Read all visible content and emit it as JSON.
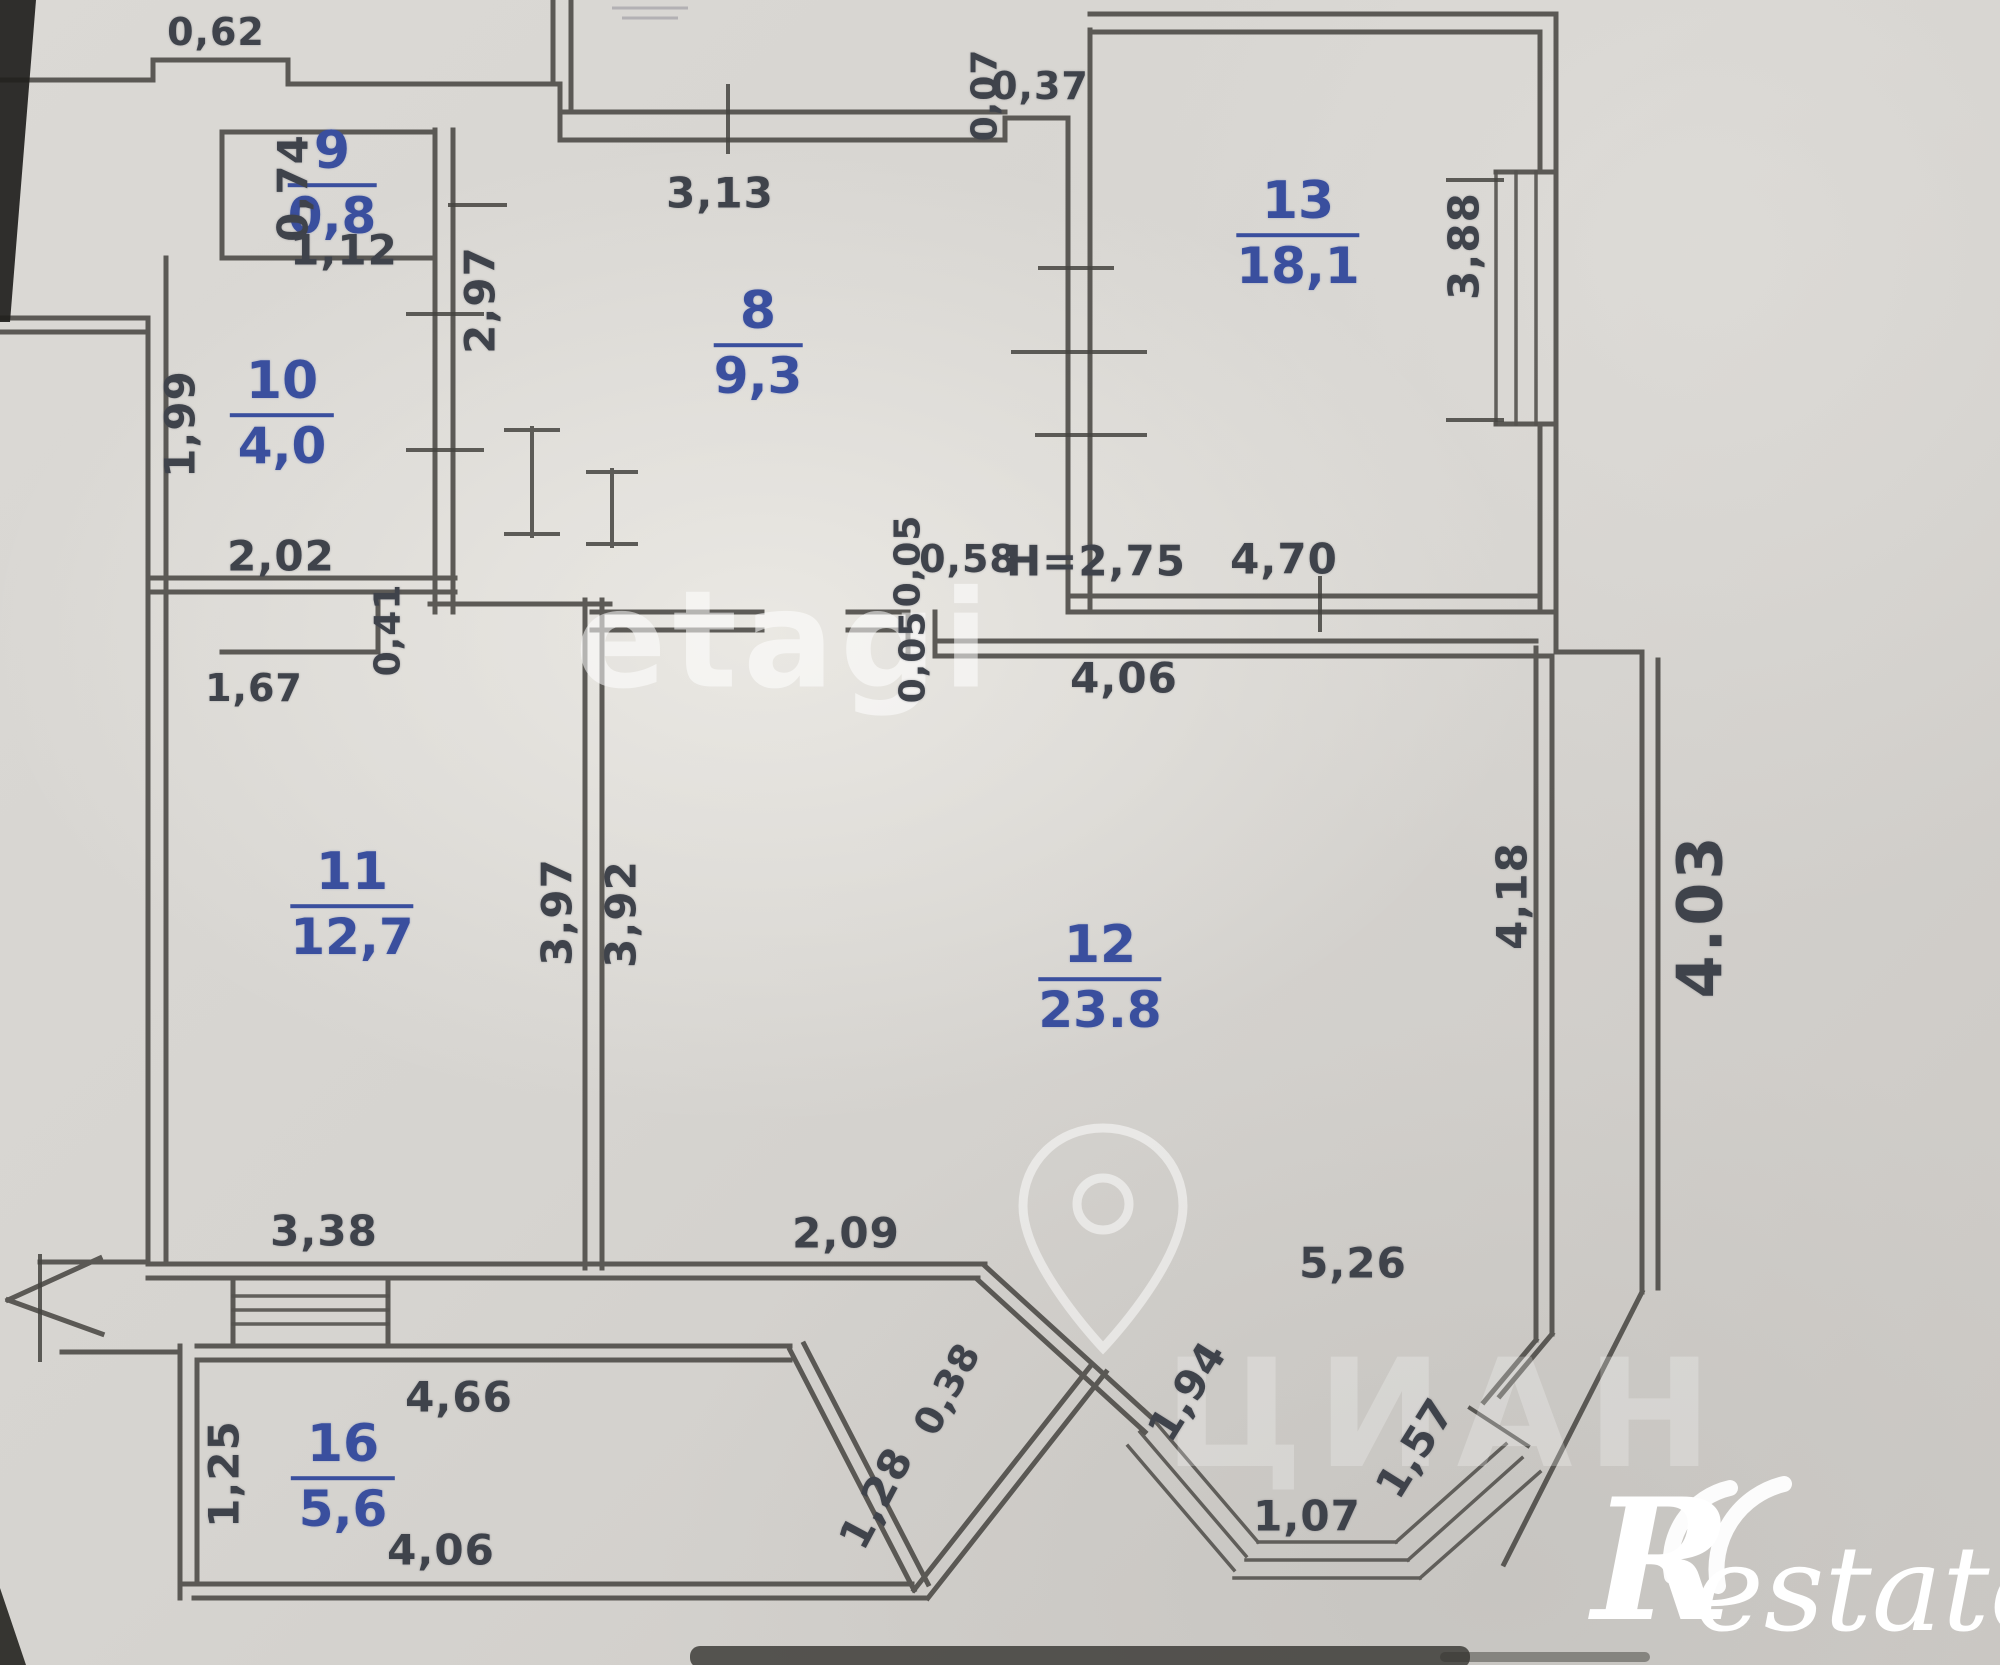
{
  "plan": {
    "type": "apartment-floor-plan",
    "rooms": [
      {
        "number": "9",
        "area": "0,8"
      },
      {
        "number": "10",
        "area": "4,0"
      },
      {
        "number": "8",
        "area": "9,3"
      },
      {
        "number": "13",
        "area": "18,1"
      },
      {
        "number": "11",
        "area": "12,7"
      },
      {
        "number": "12",
        "area": "23.8"
      },
      {
        "number": "16",
        "area": "5,6"
      }
    ],
    "dims": {
      "d0_62": "0,62",
      "d0_74": "0,74",
      "d1_12": "1,12",
      "d3_13": "3,13",
      "d0_07": "0,07",
      "d0_37": "0,37",
      "d2_97": "2,97",
      "d1_99": "1,99",
      "d2_02": "2,02",
      "d3_88": "3,88",
      "dH": "H=2,75",
      "d4_70": "4,70",
      "d0_05a": "0,05",
      "d0_58": "0,58",
      "d0_05b": "0,05",
      "d4_06top": "4,06",
      "d1_67": "1,67",
      "d0_41": "0,41",
      "d3_97": "3,97",
      "d3_92": "3,92",
      "d4_18": "4,18",
      "d4_03": "4.03",
      "d3_38": "3,38",
      "d2_09": "2,09",
      "d5_26": "5,26",
      "d4_66": "4,66",
      "d1_25": "1,25",
      "d4_06bot": "4,06",
      "d0_38": "0,38",
      "d1_28": "1,28",
      "d1_94": "1,94",
      "d1_07": "1,07",
      "d1_57": "1,57"
    },
    "watermarks": {
      "brand": "etagi",
      "listing": "ЦИАН",
      "logo_r": "R",
      "logo_text": "estate"
    }
  }
}
